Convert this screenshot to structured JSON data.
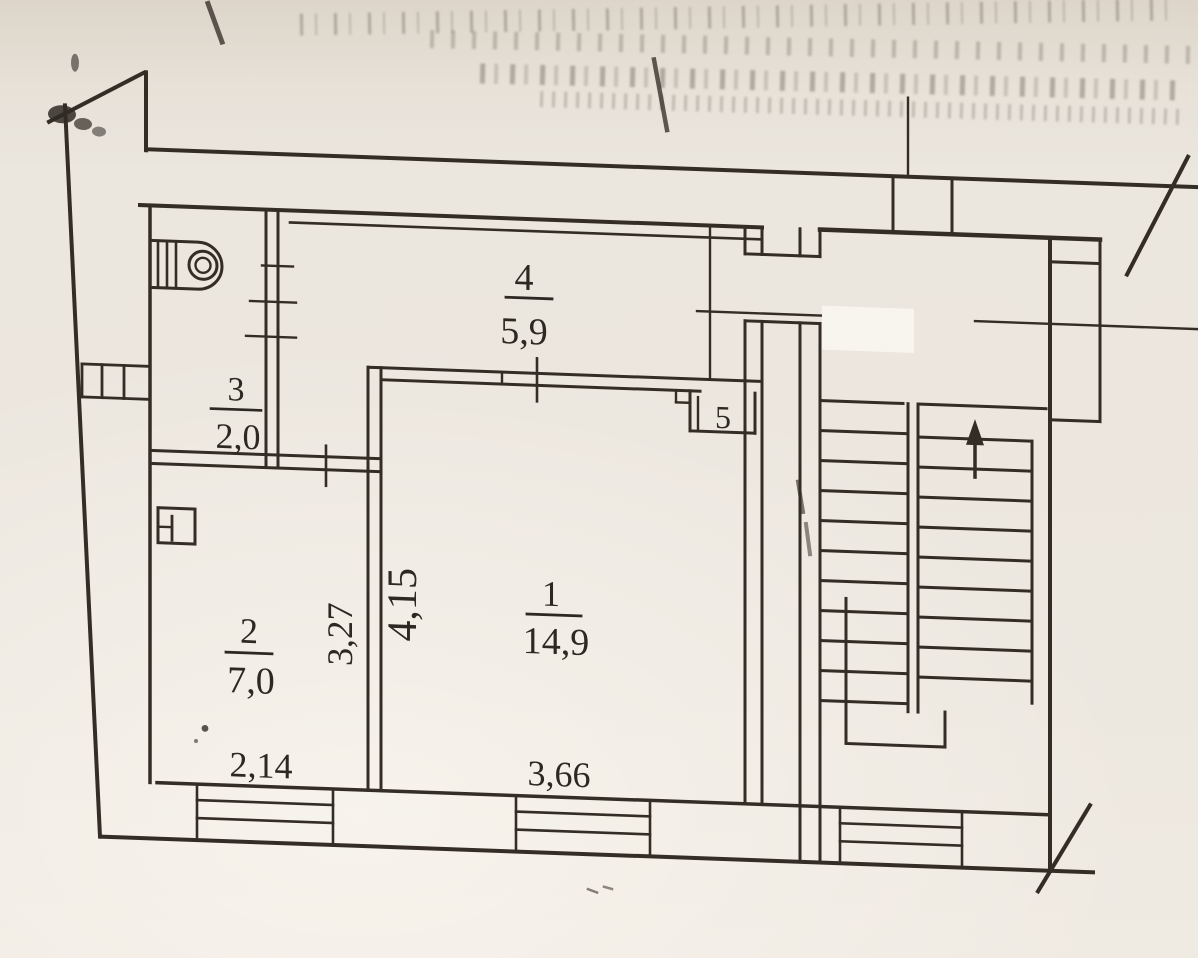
{
  "plan": {
    "title_note": "",
    "rooms": [
      {
        "number": "1",
        "area": "14,9"
      },
      {
        "number": "2",
        "area": "7,0"
      },
      {
        "number": "3",
        "area": "2,0"
      },
      {
        "number": "4",
        "area": "5,9"
      },
      {
        "number": "5",
        "area": ""
      }
    ],
    "dimensions": {
      "room2_width": "2,14",
      "room1_width": "3,66",
      "room2_depth": "3,27",
      "room1_depth": "4,15"
    },
    "icons": {
      "stove": "stove-burner-icon",
      "vent": "vent-shaft-icon",
      "window": "window-symbol",
      "stairs_direction": "up-arrow-icon"
    },
    "colors": {
      "paper": "#ece7df",
      "ink": "#332d26",
      "patch": "#f8f5ef"
    }
  }
}
